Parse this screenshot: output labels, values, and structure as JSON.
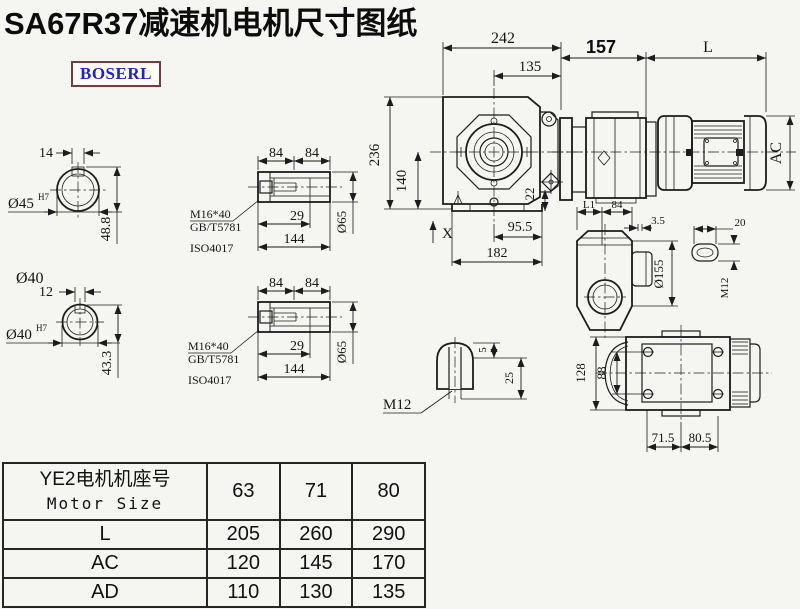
{
  "title": "SA67R37减速机电机尺寸图纸",
  "logo": "BOSERL",
  "drawing": {
    "solid_shaft_a": {
      "key_width": "14",
      "bore": "Ø45",
      "fit": "H7",
      "height": "48.8",
      "note": "Ø40"
    },
    "solid_shaft_b": {
      "key_width": "12",
      "bore": "Ø40",
      "fit": "H7",
      "height": "43.3"
    },
    "hollow_shaft_a": {
      "len_a": "84",
      "len_b": "84",
      "bolt": "M16*40",
      "std_a": "GB/T5781",
      "std_b": "ISO4017",
      "depth": "29",
      "length": "144",
      "dia": "Ø65"
    },
    "hollow_shaft_b": {
      "len_a": "84",
      "len_b": "84",
      "bolt": "M16*40",
      "std_a": "GB/T5781",
      "std_b": "ISO4017",
      "depth": "29",
      "length": "144",
      "dia": "Ø65"
    },
    "front_view": {
      "overall_width": "242",
      "center_to_face": "135",
      "overall_height": "236",
      "center_height": "140",
      "foot_height": "22",
      "x_mark": "X",
      "center_to_edge": "95.5",
      "base_width": "182"
    },
    "side_view": {
      "gear_length": "157",
      "motor_length": "L",
      "motor_height": "AC",
      "hub_len": "L1",
      "hub_width": "84"
    },
    "flange_view": {
      "gap": "3.5",
      "slot_width": "20",
      "flange_dia": "Ø155",
      "thread": "M12"
    },
    "plug_detail": {
      "lip": "5",
      "depth": "25",
      "thread": "M12"
    },
    "bottom_view": {
      "overall_depth": "128",
      "bolt_spacing": "88",
      "foot_left": "71.5",
      "foot_right": "80.5"
    }
  },
  "table": {
    "header_cn": "YE2电机机座号",
    "header_en": "Motor Size",
    "sizes": [
      "63",
      "71",
      "80"
    ],
    "rows": [
      {
        "label": "L",
        "values": [
          "205",
          "260",
          "290"
        ]
      },
      {
        "label": "AC",
        "values": [
          "120",
          "145",
          "170"
        ]
      },
      {
        "label": "AD",
        "values": [
          "110",
          "130",
          "135"
        ]
      }
    ]
  },
  "colors": {
    "line": "#1c1c1c",
    "background": "#f5f5f2",
    "logo_text": "#2323bd",
    "logo_border": "#6e4040"
  }
}
